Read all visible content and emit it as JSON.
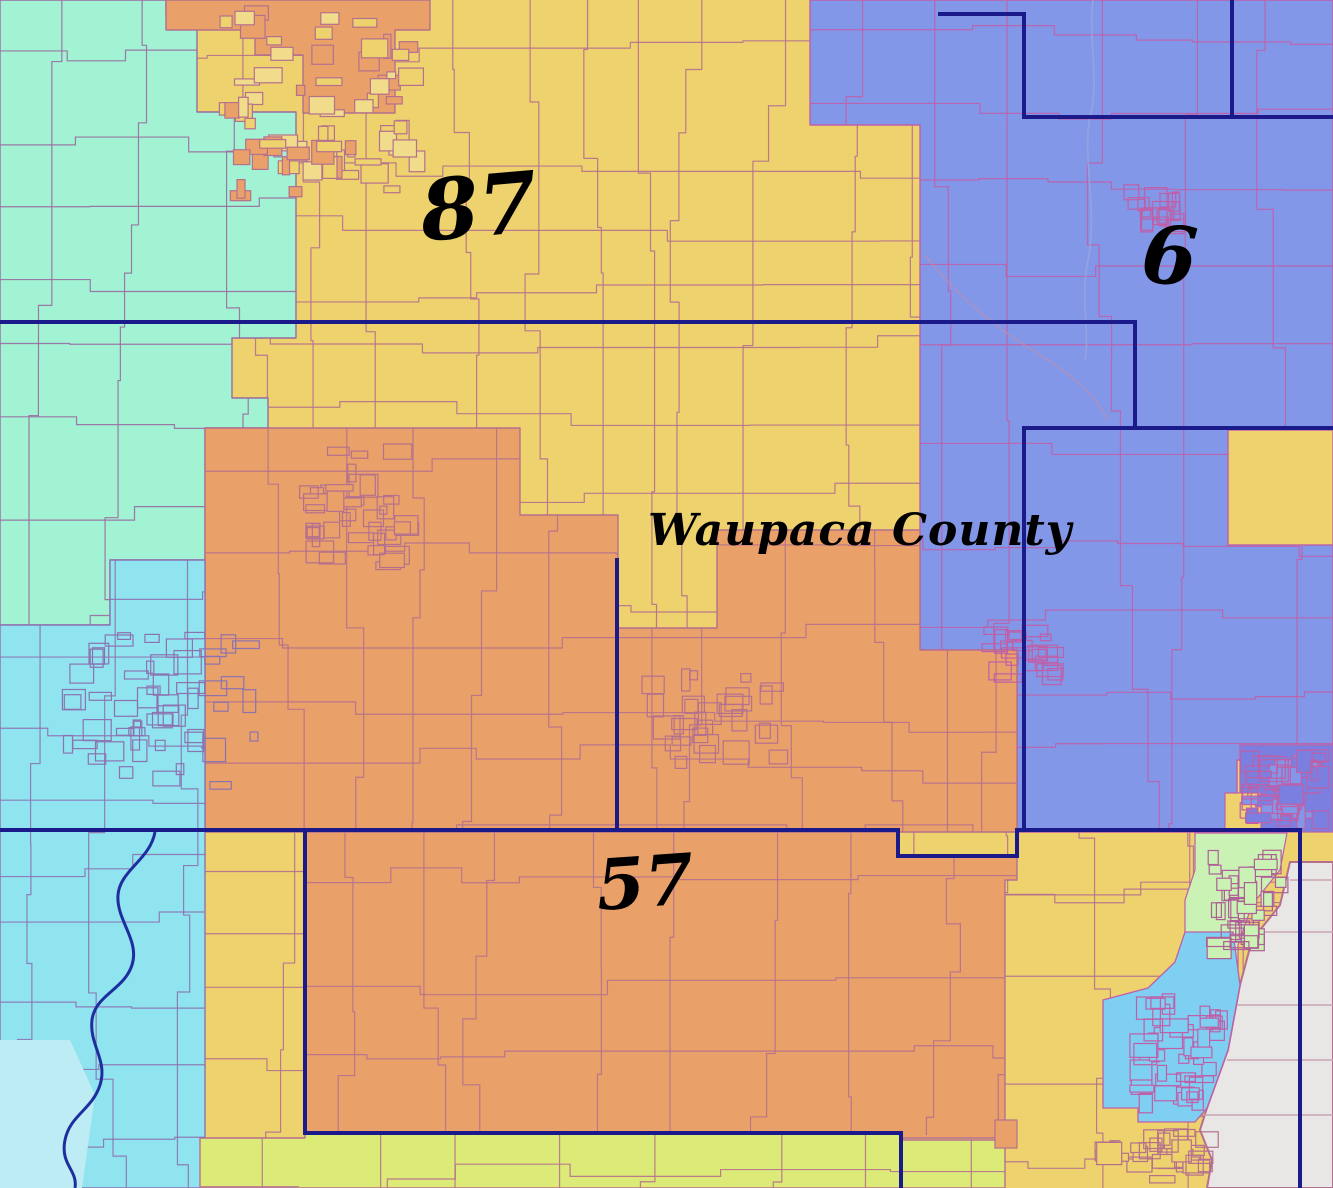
{
  "map": {
    "county_label": "Waupaca County",
    "district_labels": [
      {
        "id": "87",
        "text": "87"
      },
      {
        "id": "6",
        "text": "6"
      },
      {
        "id": "57",
        "text": "57"
      }
    ]
  },
  "colors": {
    "yellow": "#edd26e",
    "teal": "#a2f2d4",
    "orange": "#e9a169",
    "blue": "#8397e8",
    "blue_dense": "#7b80e0",
    "cyan": "#8fe4f0",
    "cyan_pale": "#bdecf4",
    "green_strip": "#dcea77",
    "light_green": "#c9f2b4",
    "city_blue": "#7ecff2",
    "water": "#e9e7e6",
    "line_rose": "#b5708e",
    "line_purple": "#9a6ba0",
    "line_cyanzone": "#8d72b0",
    "line_magenta": "#bf5fa8",
    "line_water": "#c9a3b4",
    "district_line": "#1a1a8a",
    "river": "#1f2e9e",
    "label_ink": "#000000"
  }
}
